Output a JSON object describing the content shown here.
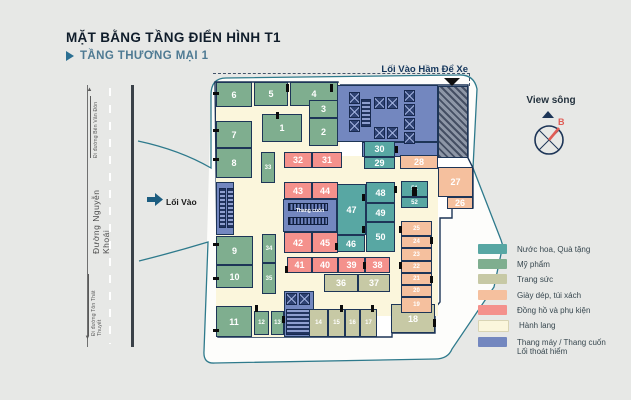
{
  "header": {
    "title": "MẶT BẰNG TẦNG ĐIỂN HÌNH T1",
    "subtitle": "TẦNG THƯƠNG MẠI 1"
  },
  "labels": {
    "parking_entrance": "Lối Vào Hầm Để Xe",
    "entrance": "Lối Vào",
    "escalator": "Thang cuốn",
    "view_river": "View sông",
    "compass_north": "B",
    "road_name": "Đường Nguyễn Khoái",
    "road_dir_top": "Đi đường Bến Vân Đồn",
    "road_dir_bottom": "Đi đường Tôn Thất Thuyết"
  },
  "legend": {
    "items": [
      {
        "key": "teal",
        "label": "Nước hoa, Quà tặng",
        "color": "#58a7a3"
      },
      {
        "key": "green",
        "label": "Mỹ phẩm",
        "color": "#7fae8f"
      },
      {
        "key": "olive",
        "label": "Trang sức",
        "color": "#c7c9a5"
      },
      {
        "key": "peach",
        "label": "Giày dép, túi xách",
        "color": "#f5c09e"
      },
      {
        "key": "pink",
        "label": "Đồng hồ và phụ kiện",
        "color": "#f4918c"
      },
      {
        "key": "cream",
        "label": "Hành lang",
        "color": "#fbf6dc"
      },
      {
        "key": "blue",
        "label": "Thang máy / Thang cuốn",
        "label2": "Lối thoát hiểm",
        "color": "#7387bf"
      }
    ]
  },
  "plan": {
    "units": [
      {
        "n": "6",
        "cat": "green",
        "x": 216,
        "y": 82,
        "w": 36,
        "h": 25
      },
      {
        "n": "5",
        "cat": "green",
        "x": 254,
        "y": 82,
        "w": 34,
        "h": 24
      },
      {
        "n": "4",
        "cat": "green",
        "x": 290,
        "y": 82,
        "w": 48,
        "h": 24
      },
      {
        "n": "3",
        "cat": "green",
        "x": 309,
        "y": 100,
        "w": 29,
        "h": 18
      },
      {
        "n": "2",
        "cat": "green",
        "x": 309,
        "y": 118,
        "w": 29,
        "h": 28
      },
      {
        "n": "1",
        "cat": "green",
        "x": 262,
        "y": 114,
        "w": 40,
        "h": 28
      },
      {
        "n": "7",
        "cat": "green",
        "x": 216,
        "y": 121,
        "w": 36,
        "h": 27
      },
      {
        "n": "8",
        "cat": "green",
        "x": 216,
        "y": 148,
        "w": 36,
        "h": 30
      },
      {
        "n": "33",
        "cat": "green",
        "x": 261,
        "y": 152,
        "w": 14,
        "h": 31,
        "s": 1
      },
      {
        "n": "9",
        "cat": "green",
        "x": 216,
        "y": 236,
        "w": 37,
        "h": 29
      },
      {
        "n": "10",
        "cat": "green",
        "x": 216,
        "y": 265,
        "w": 37,
        "h": 23
      },
      {
        "n": "34",
        "cat": "green",
        "x": 262,
        "y": 234,
        "w": 14,
        "h": 29,
        "s": 1
      },
      {
        "n": "35",
        "cat": "green",
        "x": 262,
        "y": 263,
        "w": 14,
        "h": 31,
        "s": 1
      },
      {
        "n": "11",
        "cat": "green",
        "x": 216,
        "y": 306,
        "w": 36,
        "h": 31
      },
      {
        "n": "12",
        "cat": "green",
        "x": 254,
        "y": 311,
        "w": 15,
        "h": 24,
        "s": 1
      },
      {
        "n": "13",
        "cat": "green",
        "x": 271,
        "y": 311,
        "w": 13,
        "h": 24,
        "s": 1
      },
      {
        "n": "30",
        "cat": "teal",
        "x": 364,
        "y": 141,
        "w": 31,
        "h": 16
      },
      {
        "n": "29",
        "cat": "teal",
        "x": 364,
        "y": 157,
        "w": 31,
        "h": 12
      },
      {
        "n": "48",
        "cat": "teal",
        "x": 366,
        "y": 182,
        "w": 29,
        "h": 21
      },
      {
        "n": "49",
        "cat": "teal",
        "x": 366,
        "y": 203,
        "w": 29,
        "h": 19
      },
      {
        "n": "50",
        "cat": "teal",
        "x": 366,
        "y": 222,
        "w": 29,
        "h": 30
      },
      {
        "n": "47",
        "cat": "teal",
        "x": 337,
        "y": 184,
        "w": 29,
        "h": 51
      },
      {
        "n": "46",
        "cat": "teal",
        "x": 337,
        "y": 235,
        "w": 28,
        "h": 17
      },
      {
        "n": "51",
        "cat": "teal",
        "x": 401,
        "y": 181,
        "w": 27,
        "h": 16,
        "s": 1
      },
      {
        "n": "52",
        "cat": "teal",
        "x": 401,
        "y": 197,
        "w": 27,
        "h": 11,
        "s": 1
      },
      {
        "n": "32",
        "cat": "pink",
        "x": 284,
        "y": 152,
        "w": 28,
        "h": 16
      },
      {
        "n": "31",
        "cat": "pink",
        "x": 312,
        "y": 152,
        "w": 30,
        "h": 16
      },
      {
        "n": "43",
        "cat": "pink",
        "x": 284,
        "y": 182,
        "w": 28,
        "h": 17
      },
      {
        "n": "44",
        "cat": "pink",
        "x": 312,
        "y": 182,
        "w": 26,
        "h": 17
      },
      {
        "n": "42",
        "cat": "pink",
        "x": 284,
        "y": 232,
        "w": 28,
        "h": 21
      },
      {
        "n": "45",
        "cat": "pink",
        "x": 312,
        "y": 232,
        "w": 26,
        "h": 21
      },
      {
        "n": "41",
        "cat": "pink",
        "x": 287,
        "y": 257,
        "w": 25,
        "h": 16
      },
      {
        "n": "40",
        "cat": "pink",
        "x": 312,
        "y": 257,
        "w": 26,
        "h": 16
      },
      {
        "n": "39",
        "cat": "pink",
        "x": 338,
        "y": 257,
        "w": 27,
        "h": 16
      },
      {
        "n": "38",
        "cat": "pink",
        "x": 365,
        "y": 257,
        "w": 25,
        "h": 16
      },
      {
        "n": "36",
        "cat": "olive",
        "x": 324,
        "y": 274,
        "w": 34,
        "h": 18
      },
      {
        "n": "37",
        "cat": "olive",
        "x": 358,
        "y": 274,
        "w": 32,
        "h": 18
      },
      {
        "n": "14",
        "cat": "olive",
        "x": 309,
        "y": 309,
        "w": 19,
        "h": 28,
        "s": 1
      },
      {
        "n": "15",
        "cat": "olive",
        "x": 328,
        "y": 309,
        "w": 17,
        "h": 28,
        "s": 1
      },
      {
        "n": "16",
        "cat": "olive",
        "x": 345,
        "y": 309,
        "w": 15,
        "h": 28,
        "s": 1
      },
      {
        "n": "17",
        "cat": "olive",
        "x": 360,
        "y": 309,
        "w": 17,
        "h": 28,
        "s": 1
      },
      {
        "n": "18",
        "cat": "olive",
        "x": 391,
        "y": 304,
        "w": 44,
        "h": 29
      },
      {
        "n": "28",
        "cat": "peach",
        "x": 400,
        "y": 155,
        "w": 38,
        "h": 14
      },
      {
        "n": "27",
        "cat": "peach",
        "x": 438,
        "y": 167,
        "w": 35,
        "h": 30
      },
      {
        "n": "26",
        "cat": "peach",
        "x": 447,
        "y": 197,
        "w": 26,
        "h": 12
      },
      {
        "n": "25",
        "cat": "peach",
        "x": 401,
        "y": 221,
        "w": 31,
        "h": 15,
        "s": 1
      },
      {
        "n": "24",
        "cat": "peach",
        "x": 401,
        "y": 236,
        "w": 31,
        "h": 12,
        "s": 1
      },
      {
        "n": "23",
        "cat": "peach",
        "x": 401,
        "y": 248,
        "w": 31,
        "h": 13,
        "s": 1
      },
      {
        "n": "22",
        "cat": "peach",
        "x": 401,
        "y": 261,
        "w": 31,
        "h": 12,
        "s": 1
      },
      {
        "n": "21",
        "cat": "peach",
        "x": 401,
        "y": 273,
        "w": 31,
        "h": 12,
        "s": 1
      },
      {
        "n": "20",
        "cat": "peach",
        "x": 401,
        "y": 285,
        "w": 31,
        "h": 12,
        "s": 1
      },
      {
        "n": "19",
        "cat": "peach",
        "x": 401,
        "y": 297,
        "w": 31,
        "h": 16,
        "s": 1
      }
    ],
    "elevators": [
      [
        349,
        92
      ],
      [
        349,
        106
      ],
      [
        349,
        120
      ],
      [
        374,
        97
      ],
      [
        387,
        97
      ],
      [
        374,
        127
      ],
      [
        387,
        127
      ],
      [
        404,
        90
      ],
      [
        404,
        104
      ],
      [
        404,
        118
      ],
      [
        404,
        132
      ],
      [
        286,
        293
      ],
      [
        299,
        293
      ]
    ],
    "doors": [
      [
        286,
        84,
        3,
        8
      ],
      [
        330,
        84,
        3,
        8
      ],
      [
        276,
        112,
        3,
        7
      ],
      [
        213,
        92,
        6,
        3
      ],
      [
        213,
        129,
        6,
        3
      ],
      [
        213,
        158,
        6,
        3
      ],
      [
        213,
        243,
        6,
        3
      ],
      [
        213,
        277,
        6,
        3
      ],
      [
        213,
        329,
        6,
        3
      ],
      [
        395,
        146,
        3,
        7
      ],
      [
        362,
        194,
        3,
        7
      ],
      [
        362,
        226,
        3,
        7
      ],
      [
        394,
        186,
        3,
        7
      ],
      [
        335,
        243,
        3,
        7
      ],
      [
        285,
        266,
        3,
        7
      ],
      [
        363,
        262,
        3,
        7
      ],
      [
        399,
        226,
        3,
        7
      ],
      [
        399,
        262,
        3,
        7
      ],
      [
        430,
        237,
        3,
        7
      ],
      [
        430,
        276,
        3,
        7
      ],
      [
        412,
        187,
        5,
        9
      ],
      [
        433,
        319,
        3,
        8
      ],
      [
        282,
        316,
        3,
        7
      ],
      [
        340,
        305,
        3,
        7
      ],
      [
        371,
        305,
        3,
        7
      ],
      [
        255,
        305,
        3,
        7
      ]
    ]
  }
}
